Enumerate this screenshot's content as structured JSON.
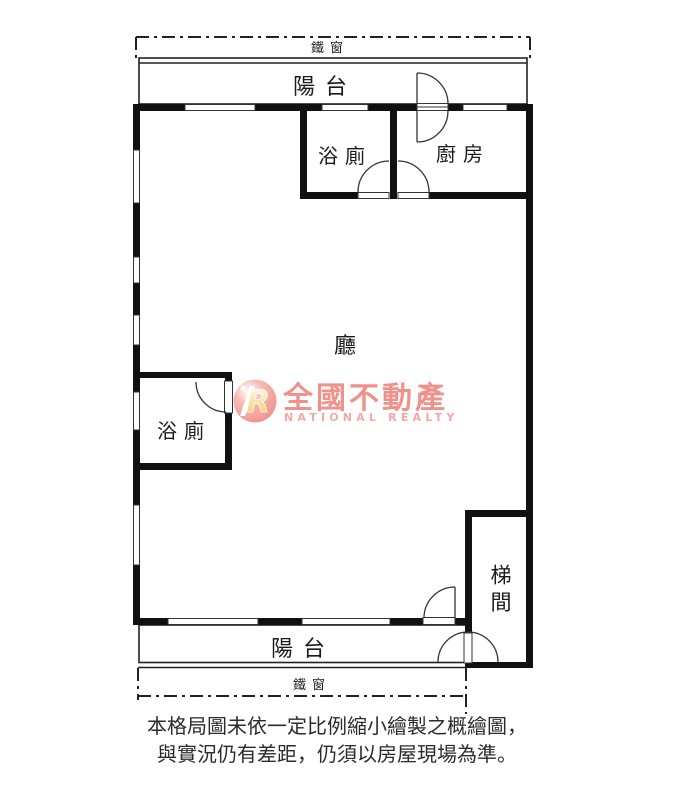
{
  "plan": {
    "iron_window_top": "鐵窗",
    "iron_window_bottom": "鐵窗",
    "rooms": {
      "balcony_top": "陽台",
      "bathroom_top": "浴廁",
      "kitchen": "廚房",
      "living_room": "廳",
      "bathroom_lower": "浴廁",
      "stairwell": "梯間",
      "balcony_bottom": "陽台"
    }
  },
  "watermark": {
    "logo_letter": "R",
    "brand_zh": "全國不動產",
    "brand_en": "NATIONAL REALTY",
    "brand_color": "#f0918b",
    "brand_color_light": "#f5a8a2"
  },
  "caption": {
    "line1": "本格局圖未依一定比例縮小繪製之概繪圖，",
    "line2": "與實況仍有差距，仍須以房屋現場為準。"
  },
  "colors": {
    "wall": "#111111",
    "thin_line": "#222222",
    "background": "#ffffff"
  }
}
